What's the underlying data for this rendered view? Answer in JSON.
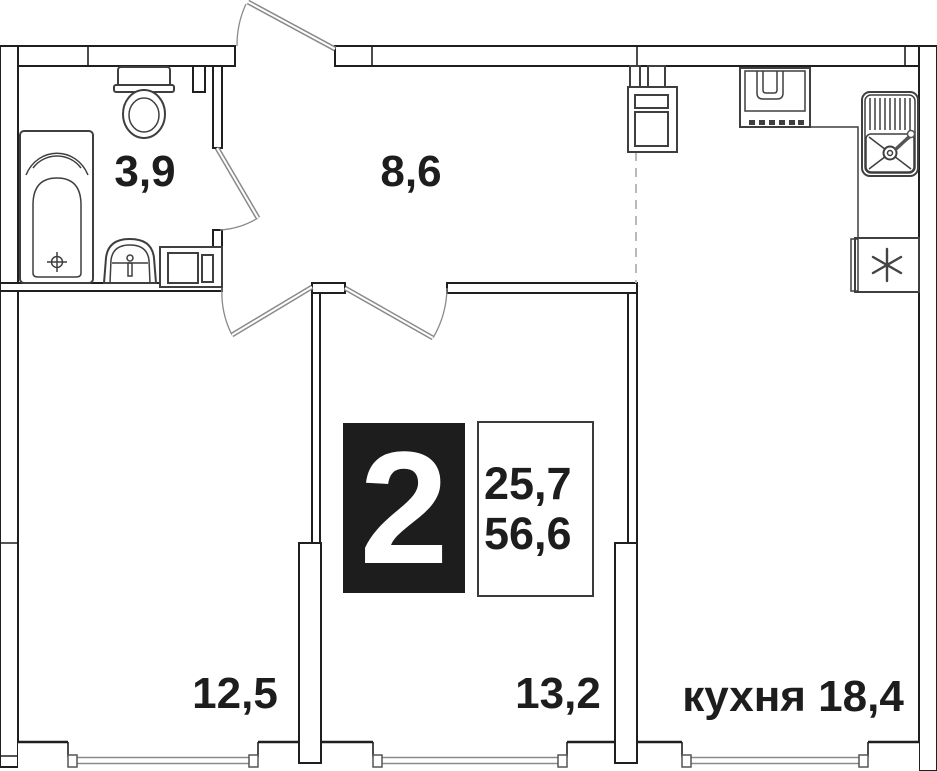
{
  "plan_title": "2-room apartment floor plan",
  "badge": {
    "rooms_count": "2",
    "living_area": "25,7",
    "total_area": "56,6"
  },
  "rooms": [
    {
      "name": "bathroom",
      "area_label": "3,9"
    },
    {
      "name": "hallway",
      "area_label": "8,6"
    },
    {
      "name": "bedroom-left",
      "area_label": "12,5"
    },
    {
      "name": "bedroom-middle",
      "area_label": "13,2"
    },
    {
      "name": "kitchen",
      "room_label": "кухня",
      "area_label": "18,4"
    }
  ],
  "fixtures": [
    "bathtub",
    "toilet",
    "washbasin",
    "washer-cabinet",
    "vent-shaft",
    "stove",
    "kitchen-sink",
    "fridge",
    "entrance-door",
    "bathroom-door",
    "bedroom-left-door",
    "bedroom-middle-door",
    "windows",
    "open-kitchen-boundary"
  ],
  "colors": {
    "wall": "#1f1f1f",
    "fixture": "#3f3f3f",
    "door": "#8a8a8a",
    "window": "#8a8a8a",
    "dashed_boundary": "#b8b8b8",
    "text": "#1d1d1d",
    "badge_bg": "#1d1d1d",
    "badge_text": "#ffffff",
    "background": "#ffffff"
  }
}
